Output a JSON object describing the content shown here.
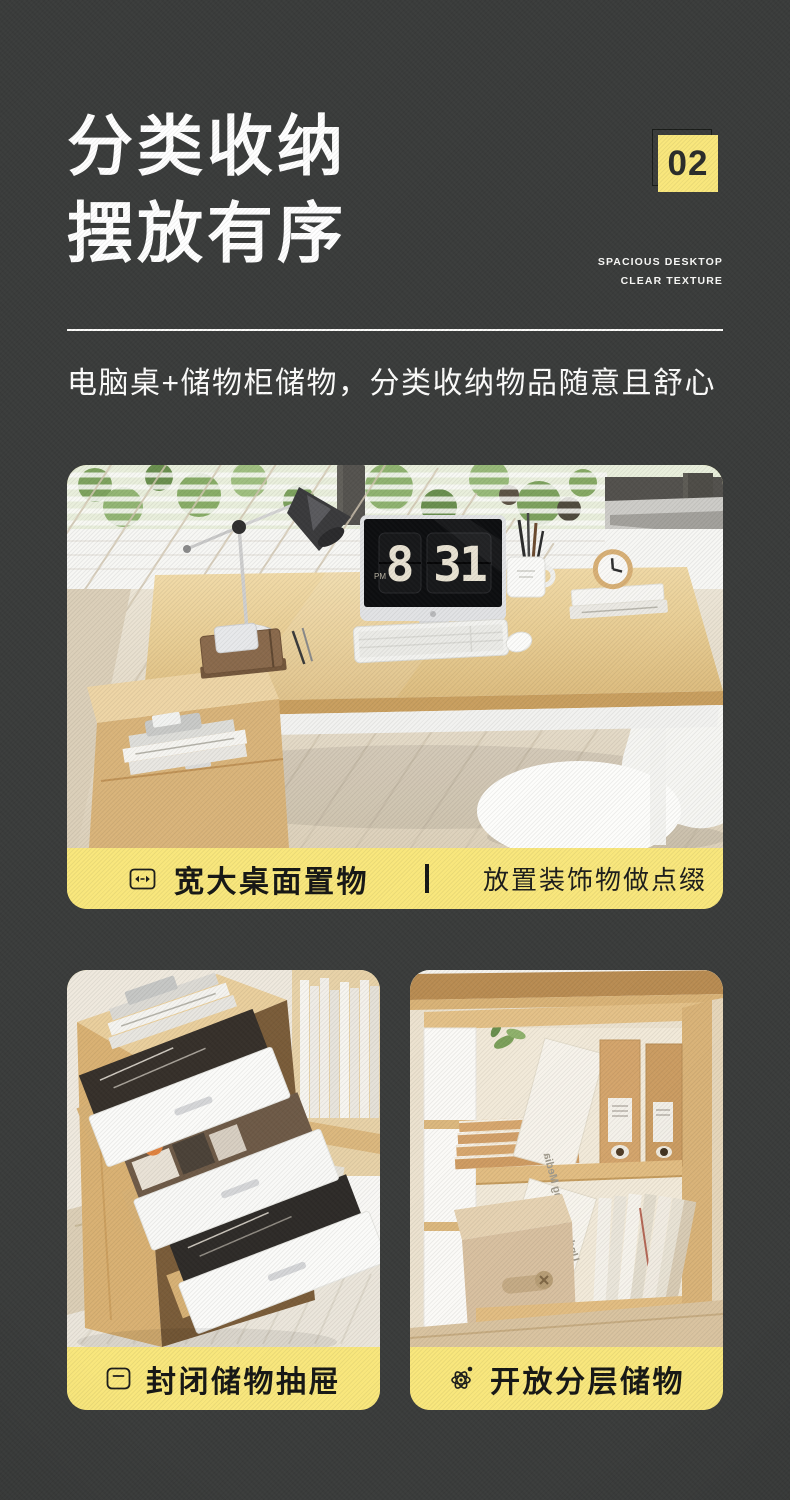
{
  "page": {
    "background_color": "#3a3c3b",
    "accent_color": "#f9e77c",
    "text_color": "#ffffff"
  },
  "header": {
    "title_line1": "分类收纳",
    "title_line2": "摆放有序",
    "badge_number": "02",
    "tagline_line1": "SPACIOUS DESKTOP",
    "tagline_line2": "CLEAR TEXTURE"
  },
  "intro": {
    "text": "电脑桌+储物柜储物，分类收纳物品随意且舒心"
  },
  "main_feature": {
    "icon": "width-arrows-icon",
    "caption_primary": "宽大桌面置物",
    "caption_secondary": "放置装饰物做点缀",
    "scene": {
      "clock_hour": "8",
      "clock_minute": "31",
      "clock_meridiem": "PM"
    }
  },
  "sub_features": [
    {
      "icon": "drawer-icon",
      "caption": "封闭储物抽屉"
    },
    {
      "icon": "atom-icon",
      "caption": "开放分层储物",
      "visible_book_title": "Understanding Media"
    }
  ]
}
